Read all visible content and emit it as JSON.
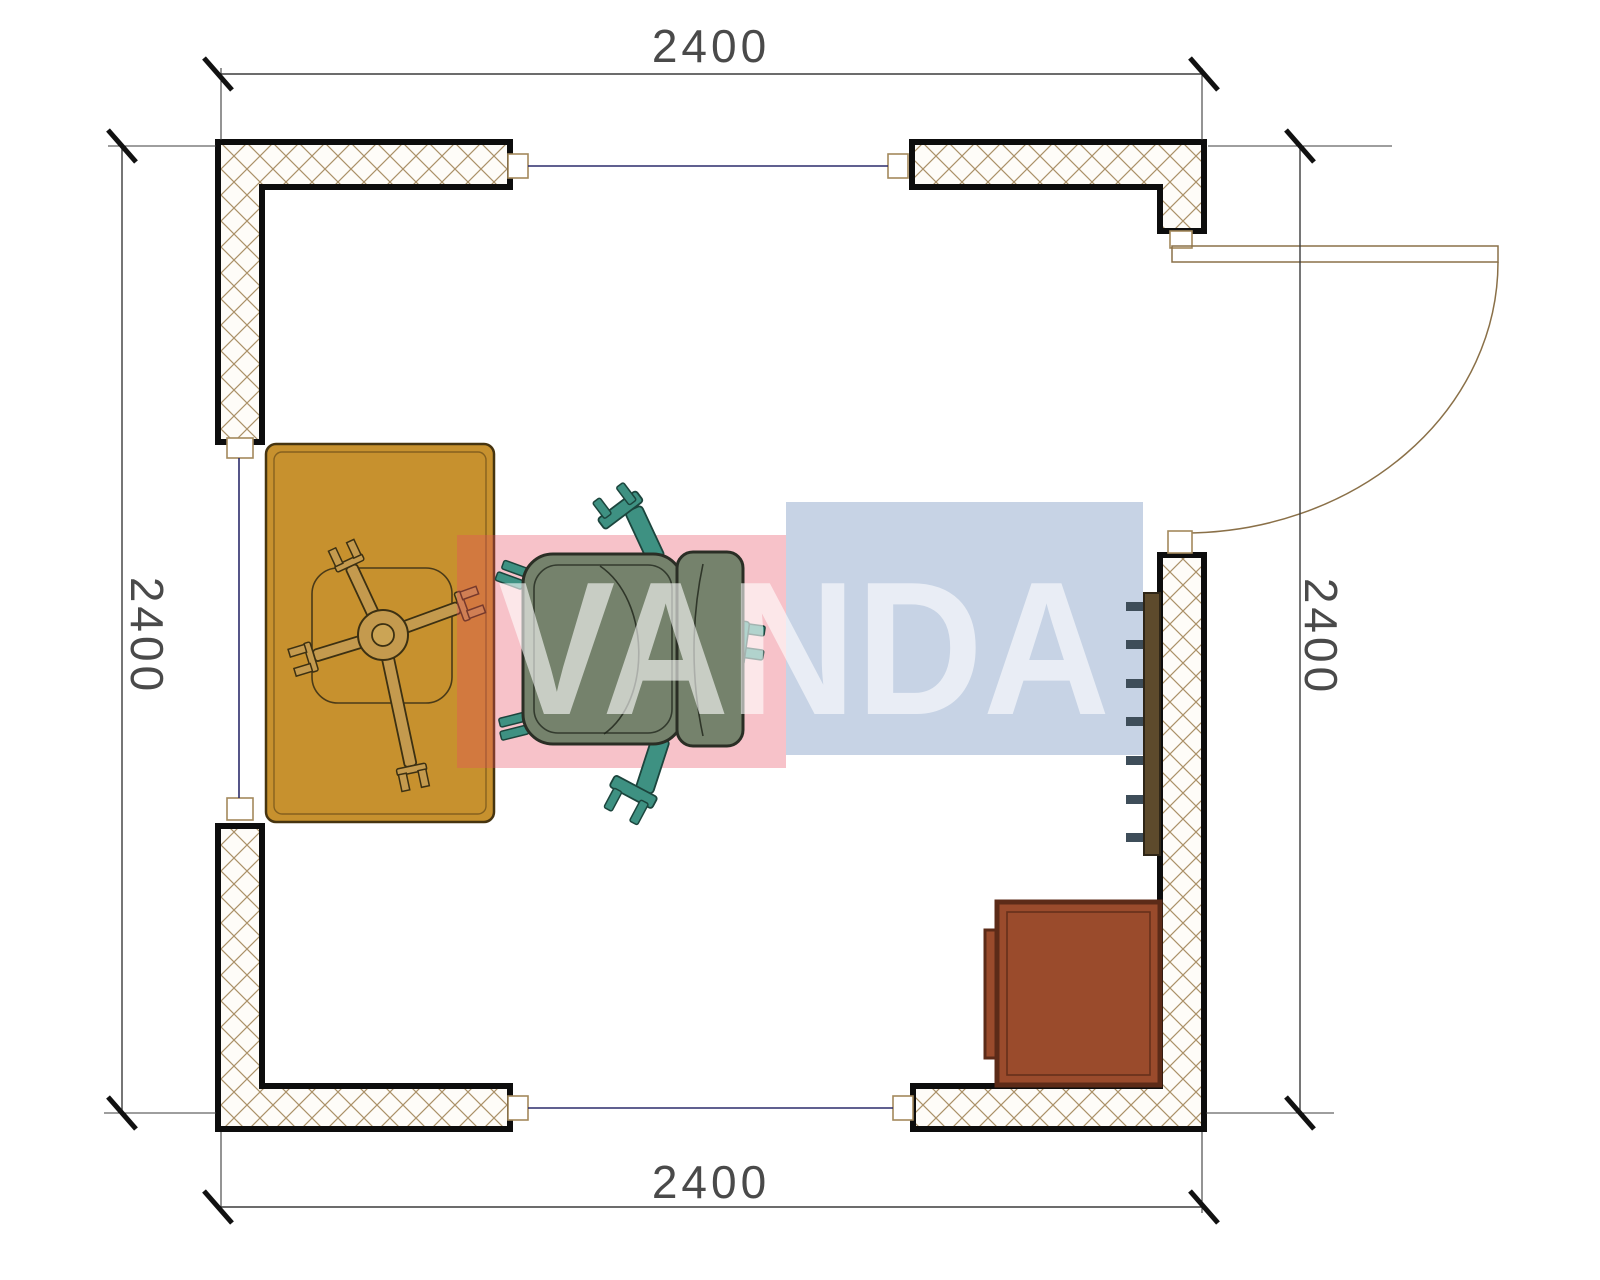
{
  "dimensions": {
    "top": "2400",
    "bottom": "2400",
    "left": "2400",
    "right": "2400"
  },
  "watermark": {
    "text": "VANDA",
    "red_block": "rgba(231,76,96,0.34)",
    "blue_block": "rgba(109,140,186,0.38)",
    "text_color": "#ffffff"
  },
  "colors": {
    "wall_outline": "#0d0d0d",
    "hatch": "#ab9168",
    "window_line": "#2b2b6b",
    "frame_box_border": "#a3895c",
    "door": "#8a7048",
    "dimension_line": "#3c3c3c",
    "dimension_text": "#4a4a4a",
    "desk": "#c7912e",
    "desk_border": "#46340f",
    "chair_base": "#c49a4e",
    "chair_base_outline": "#3c3012",
    "chair_seat": "#75826c",
    "chair_outline": "#2a2e25",
    "chair_leg": "#3e9182",
    "chair_leg_outline": "#1c453d",
    "radiator_bar": "#5d4a2c",
    "radiator_fin": "#3e4d59",
    "cabinet": "#9a4b2c",
    "cabinet_border": "#5c2b18"
  }
}
